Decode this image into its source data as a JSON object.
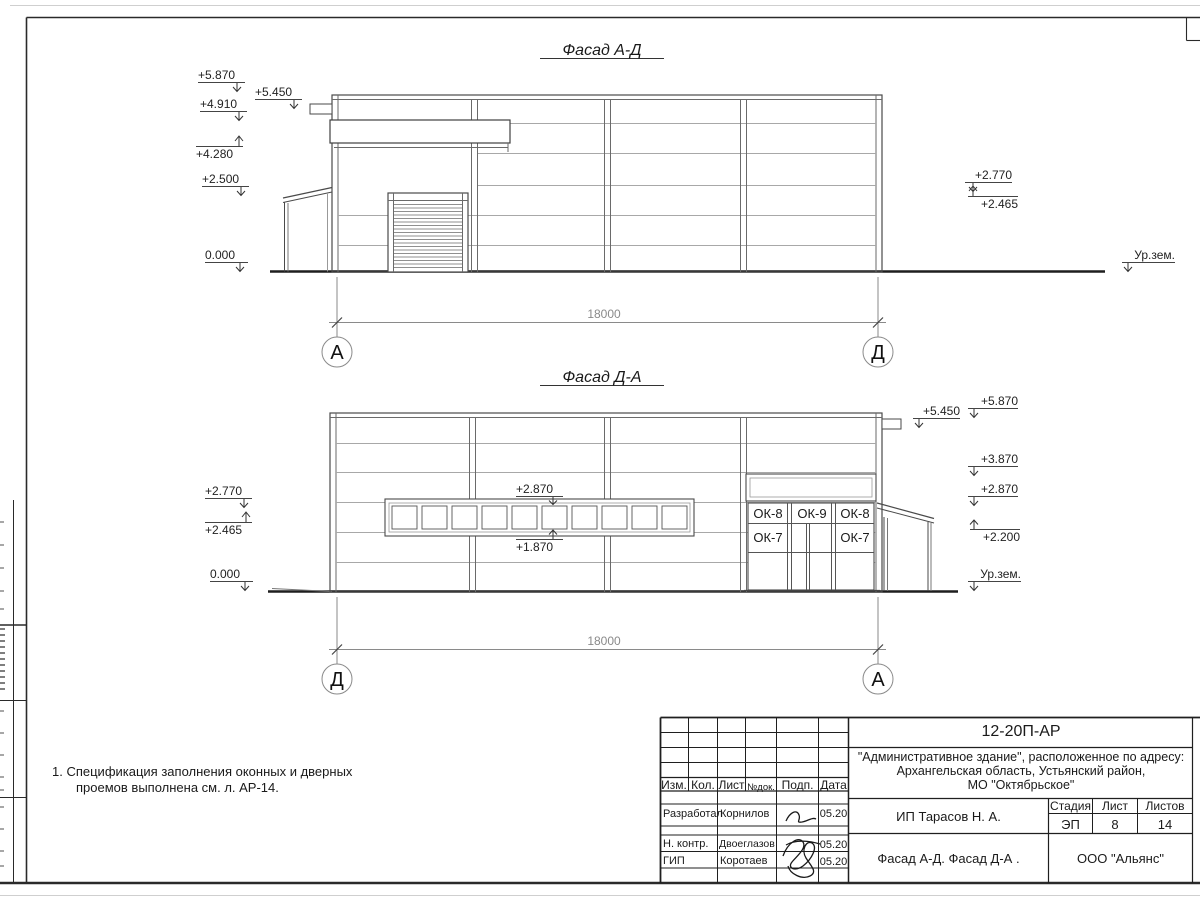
{
  "facade_top": {
    "title": "Фасад А-Д",
    "elev_5870": "+5.870",
    "elev_4910": "+4.910",
    "elev_4280": "+4.280",
    "elev_2500": "+2.500",
    "elev_0": "0.000",
    "elev_5450": "+5.450",
    "elev_2770": "+2.770",
    "elev_2465": "+2.465",
    "ground": "Ур.зем.",
    "dim": "18000",
    "axis_left": "А",
    "axis_right": "Д"
  },
  "facade_bottom": {
    "title": "Фасад Д-А",
    "elev_2770": "+2.770",
    "elev_2465": "+2.465",
    "elev_0": "0.000",
    "elev_2870_mid": "+2.870",
    "elev_1870": "+1.870",
    "elev_5870": "+5.870",
    "elev_5450": "+5.450",
    "elev_3870": "+3.870",
    "elev_2870": "+2.870",
    "elev_2200": "+2.200",
    "ground": "Ур.зем.",
    "dim": "18000",
    "axis_left": "Д",
    "axis_right": "А",
    "win_ok8": "ОК-8",
    "win_ok9": "ОК-9",
    "win_ok7": "ОК-7"
  },
  "notes": {
    "line1": "1. Спецификация заполнения оконных и дверных",
    "line2": "проемов выполнена см. л. АР-14."
  },
  "titleblock": {
    "code": "12-20П-АР",
    "project_line1": "\"Административное здание\", расположенное по адресу:",
    "project_line2": "Архангельская область, Устьянский район,",
    "project_line3": "МО \"Октябрьское\"",
    "col_izm": "Изм.",
    "col_kol": "Кол.",
    "col_list": "Лист",
    "col_ndok": "№док.",
    "col_podp": "Подп.",
    "col_data": "Дата",
    "row_dev_role": "Разработал",
    "row_dev_name": "Корнилов",
    "row_dev_date": "05.20",
    "row_ncontr_role": "Н. контр.",
    "row_ncontr_name": "Двоеглазов",
    "row_ncontr_date": "05.20",
    "row_gip_role": "ГИП",
    "row_gip_name": "Коротаев",
    "row_gip_date": "05.20",
    "client": "ИП Тарасов Н. А.",
    "stage_label": "Стадия",
    "sheet_label": "Лист",
    "sheets_label": "Листов",
    "stage": "ЭП",
    "sheet_no": "8",
    "sheets_total": "14",
    "doc_title": "Фасад А-Д. Фасад Д-А .",
    "org": "ООО \"Альянс\""
  }
}
